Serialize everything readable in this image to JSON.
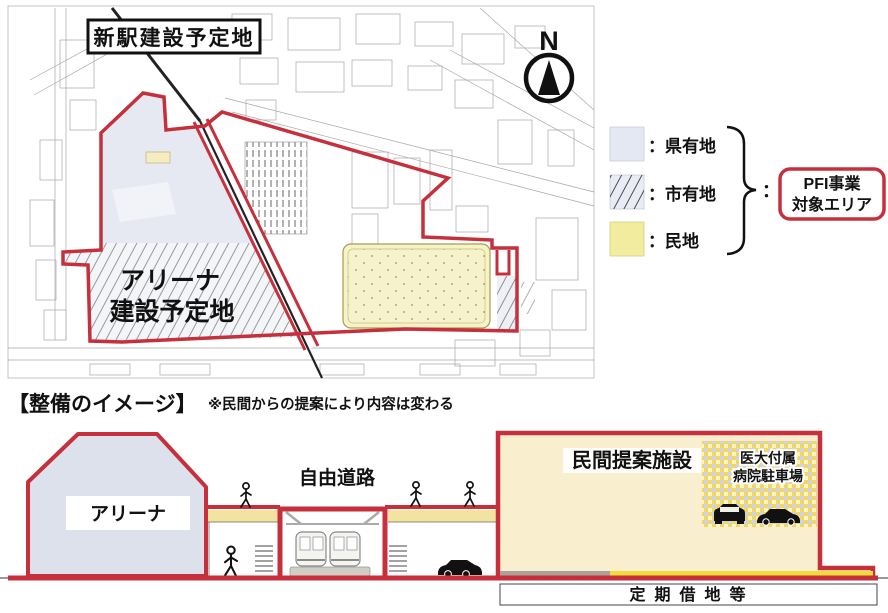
{
  "map": {
    "station_site_label": "新駅建設予定地",
    "arena_site_label_line1": "アリーナ",
    "arena_site_label_line2": "建設予定地",
    "compass_north": "N"
  },
  "legend": {
    "prefectural": "：県有地",
    "city": "：市有地",
    "private": "：民地",
    "colon": "：",
    "pfi_line1": "PFI事業",
    "pfi_line2": "対象エリア"
  },
  "section": {
    "title": "【整備のイメージ】",
    "note": "※民間からの提案により内容は変わる"
  },
  "cross_section": {
    "arena_label": "アリーナ",
    "free_road_label": "自由道路",
    "private_facility_label": "民間提案施設",
    "hospital_parking_line1": "医大付属",
    "hospital_parking_line2": "病院駐車場",
    "lease_label": "定期借地等"
  },
  "colors": {
    "boundary_red": "#c5303c",
    "prefectural_fill": "#e6e9f2",
    "private_land_fill": "#f6f2cc",
    "legend_private_fill": "#f1ec9e",
    "arena_fill": "#dde1ec",
    "facility_fill": "#f9efcf",
    "deck_yellow": "#f2e4a0",
    "strip_yellow": "#f0dc3a",
    "strip_gray": "#a9a29a"
  }
}
